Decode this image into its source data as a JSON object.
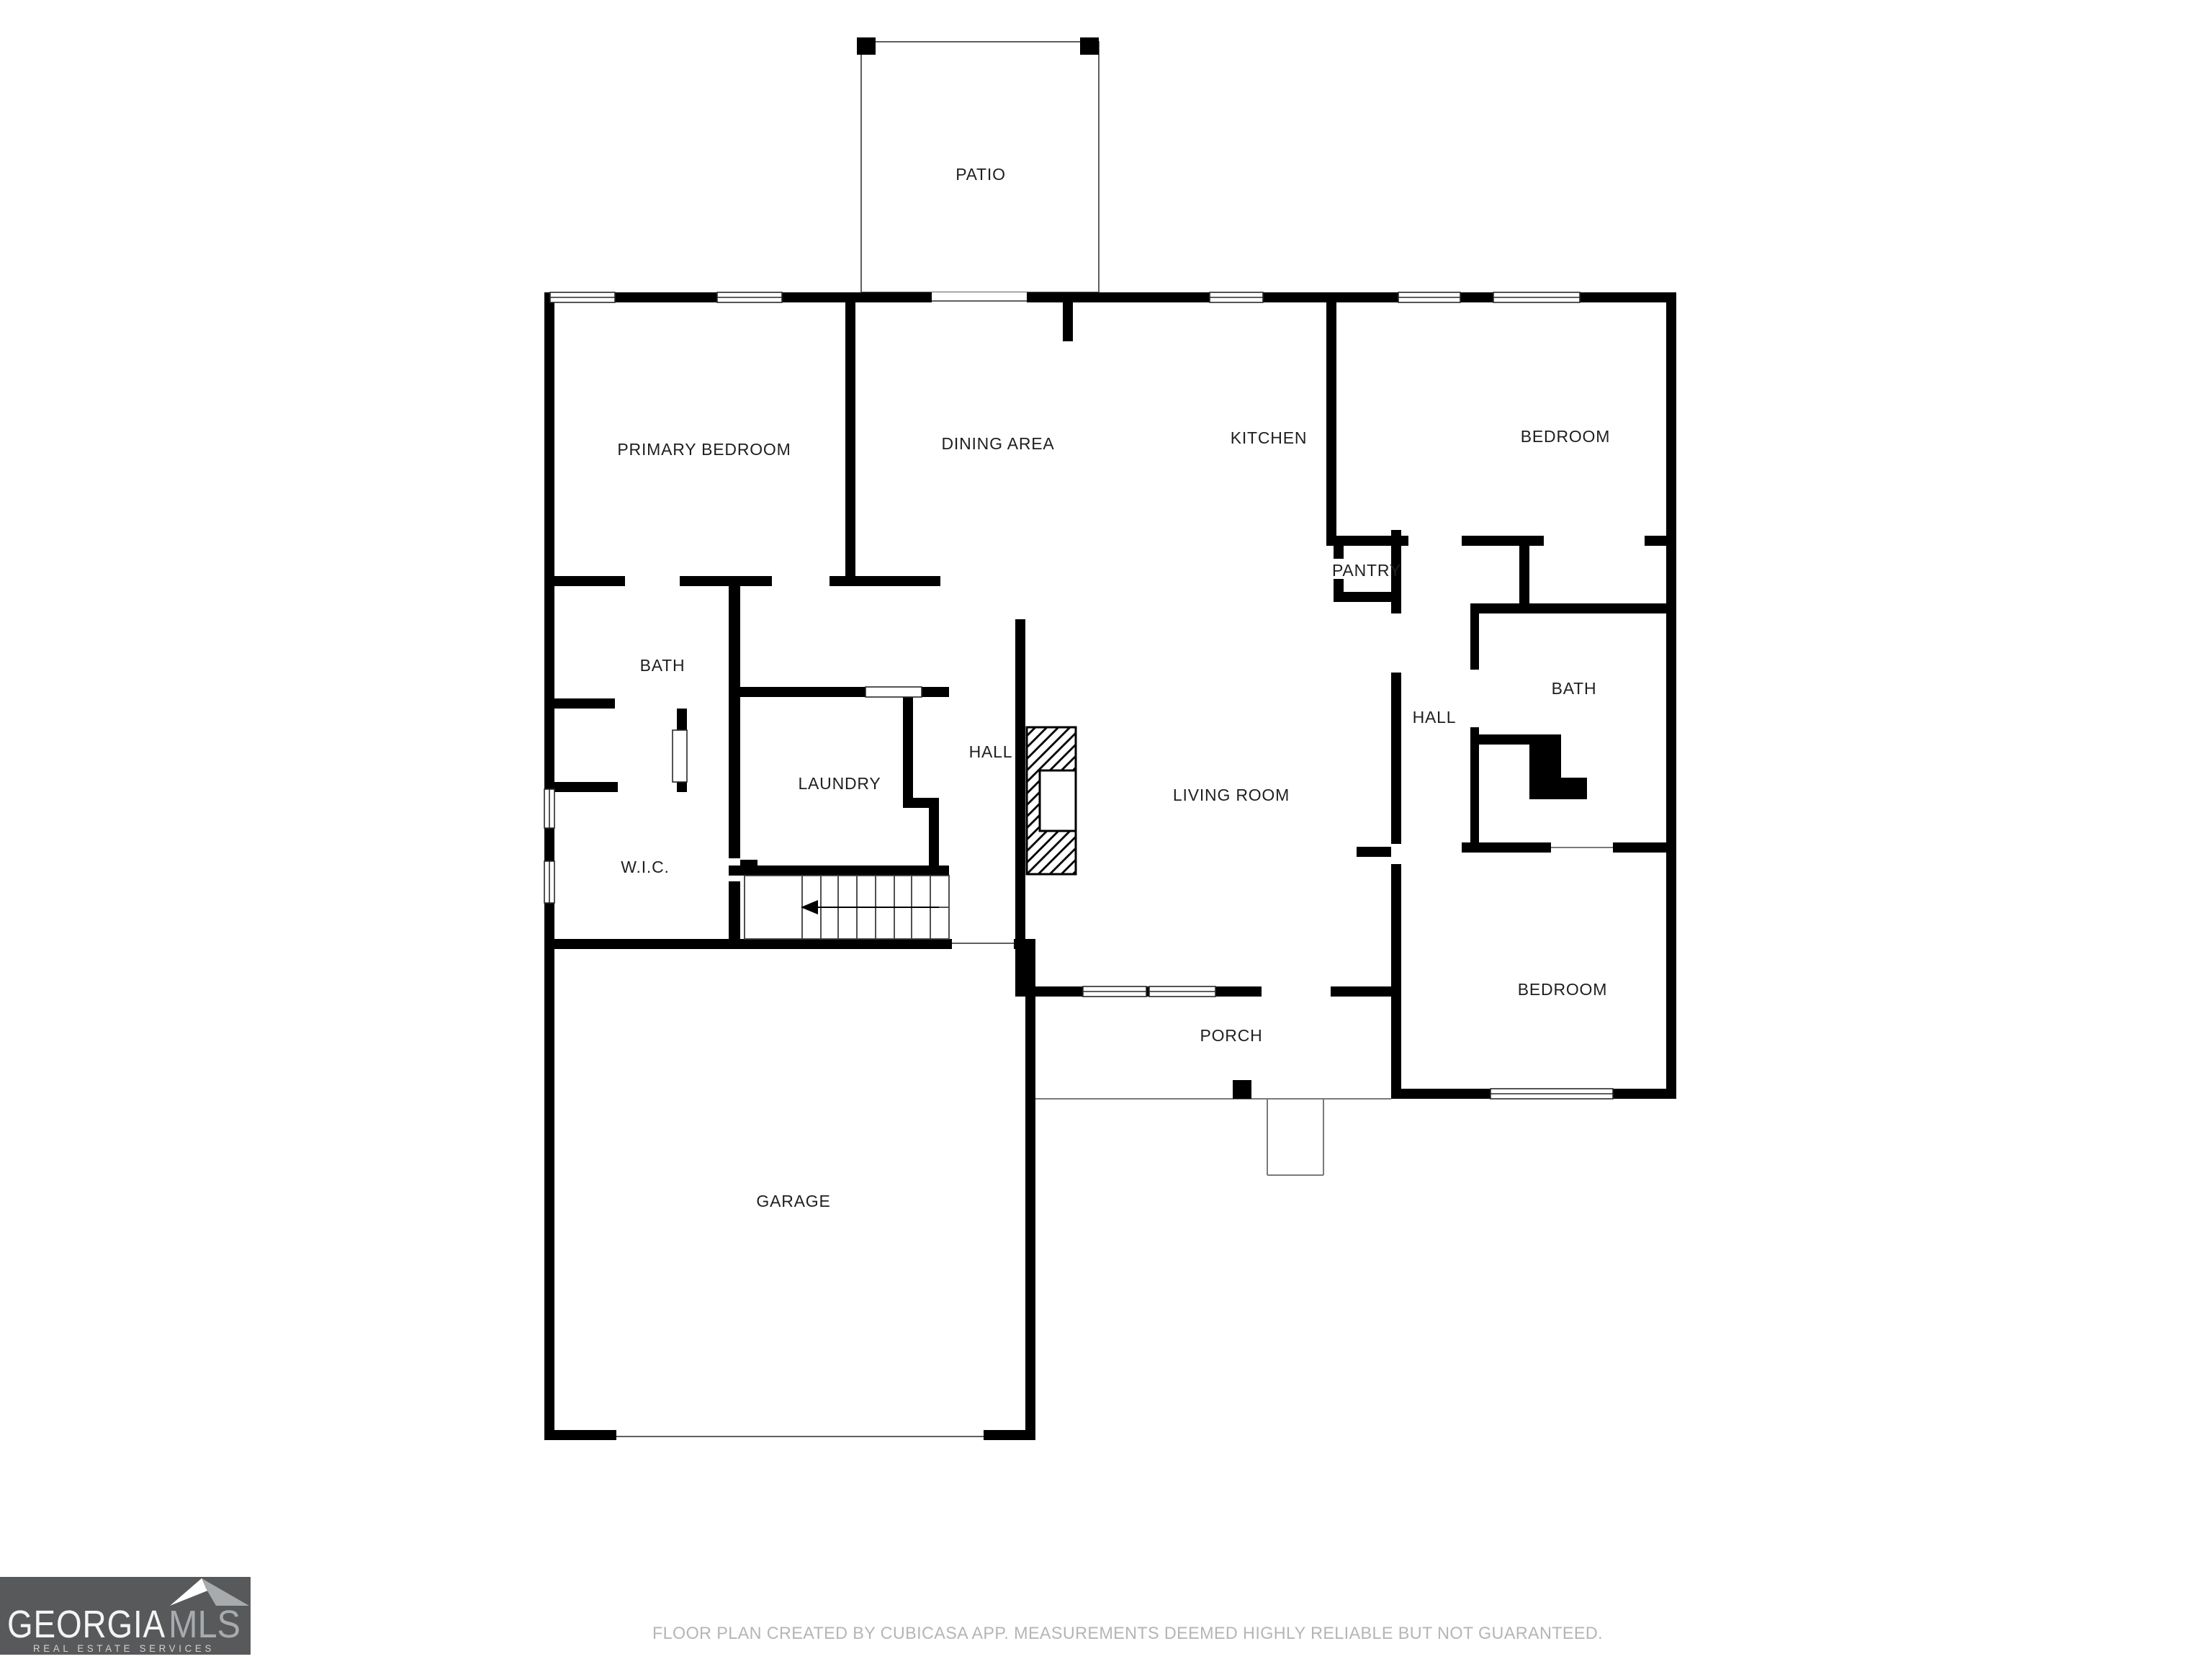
{
  "floor_plan": {
    "labels": {
      "patio": "PATIO",
      "primary_bedroom": "PRIMARY BEDROOM",
      "dining_area": "DINING AREA",
      "kitchen": "KITCHEN",
      "bedroom_top_right": "BEDROOM",
      "pantry": "PANTRY",
      "bath_left": "BATH",
      "wic": "W.I.C.",
      "laundry": "LAUNDRY",
      "hall_left": "HALL",
      "hall_right": "HALL",
      "bath_right": "BATH",
      "living_room": "LIVING ROOM",
      "porch": "PORCH",
      "bedroom_bottom_right": "BEDROOM",
      "garage": "GARAGE"
    },
    "wall_color": "#000000",
    "background_color": "#ffffff",
    "label_color": "#1f1f1f"
  },
  "branding": {
    "brand_primary": "GEORGIA",
    "brand_secondary": "MLS",
    "tagline": "REAL ESTATE SERVICES",
    "bg_color": "#58595b",
    "primary_text_color": "#f4f4f4",
    "secondary_text_color": "#a8abae",
    "tagline_color": "#d2d2d2",
    "roof_left_color": "#ffffff",
    "roof_right_color": "#a8abae"
  },
  "footer": {
    "disclaimer": "FLOOR PLAN CREATED BY CUBICASA APP. MEASUREMENTS DEEMED HIGHLY RELIABLE BUT NOT GUARANTEED.",
    "color": "#b5b5b5"
  }
}
